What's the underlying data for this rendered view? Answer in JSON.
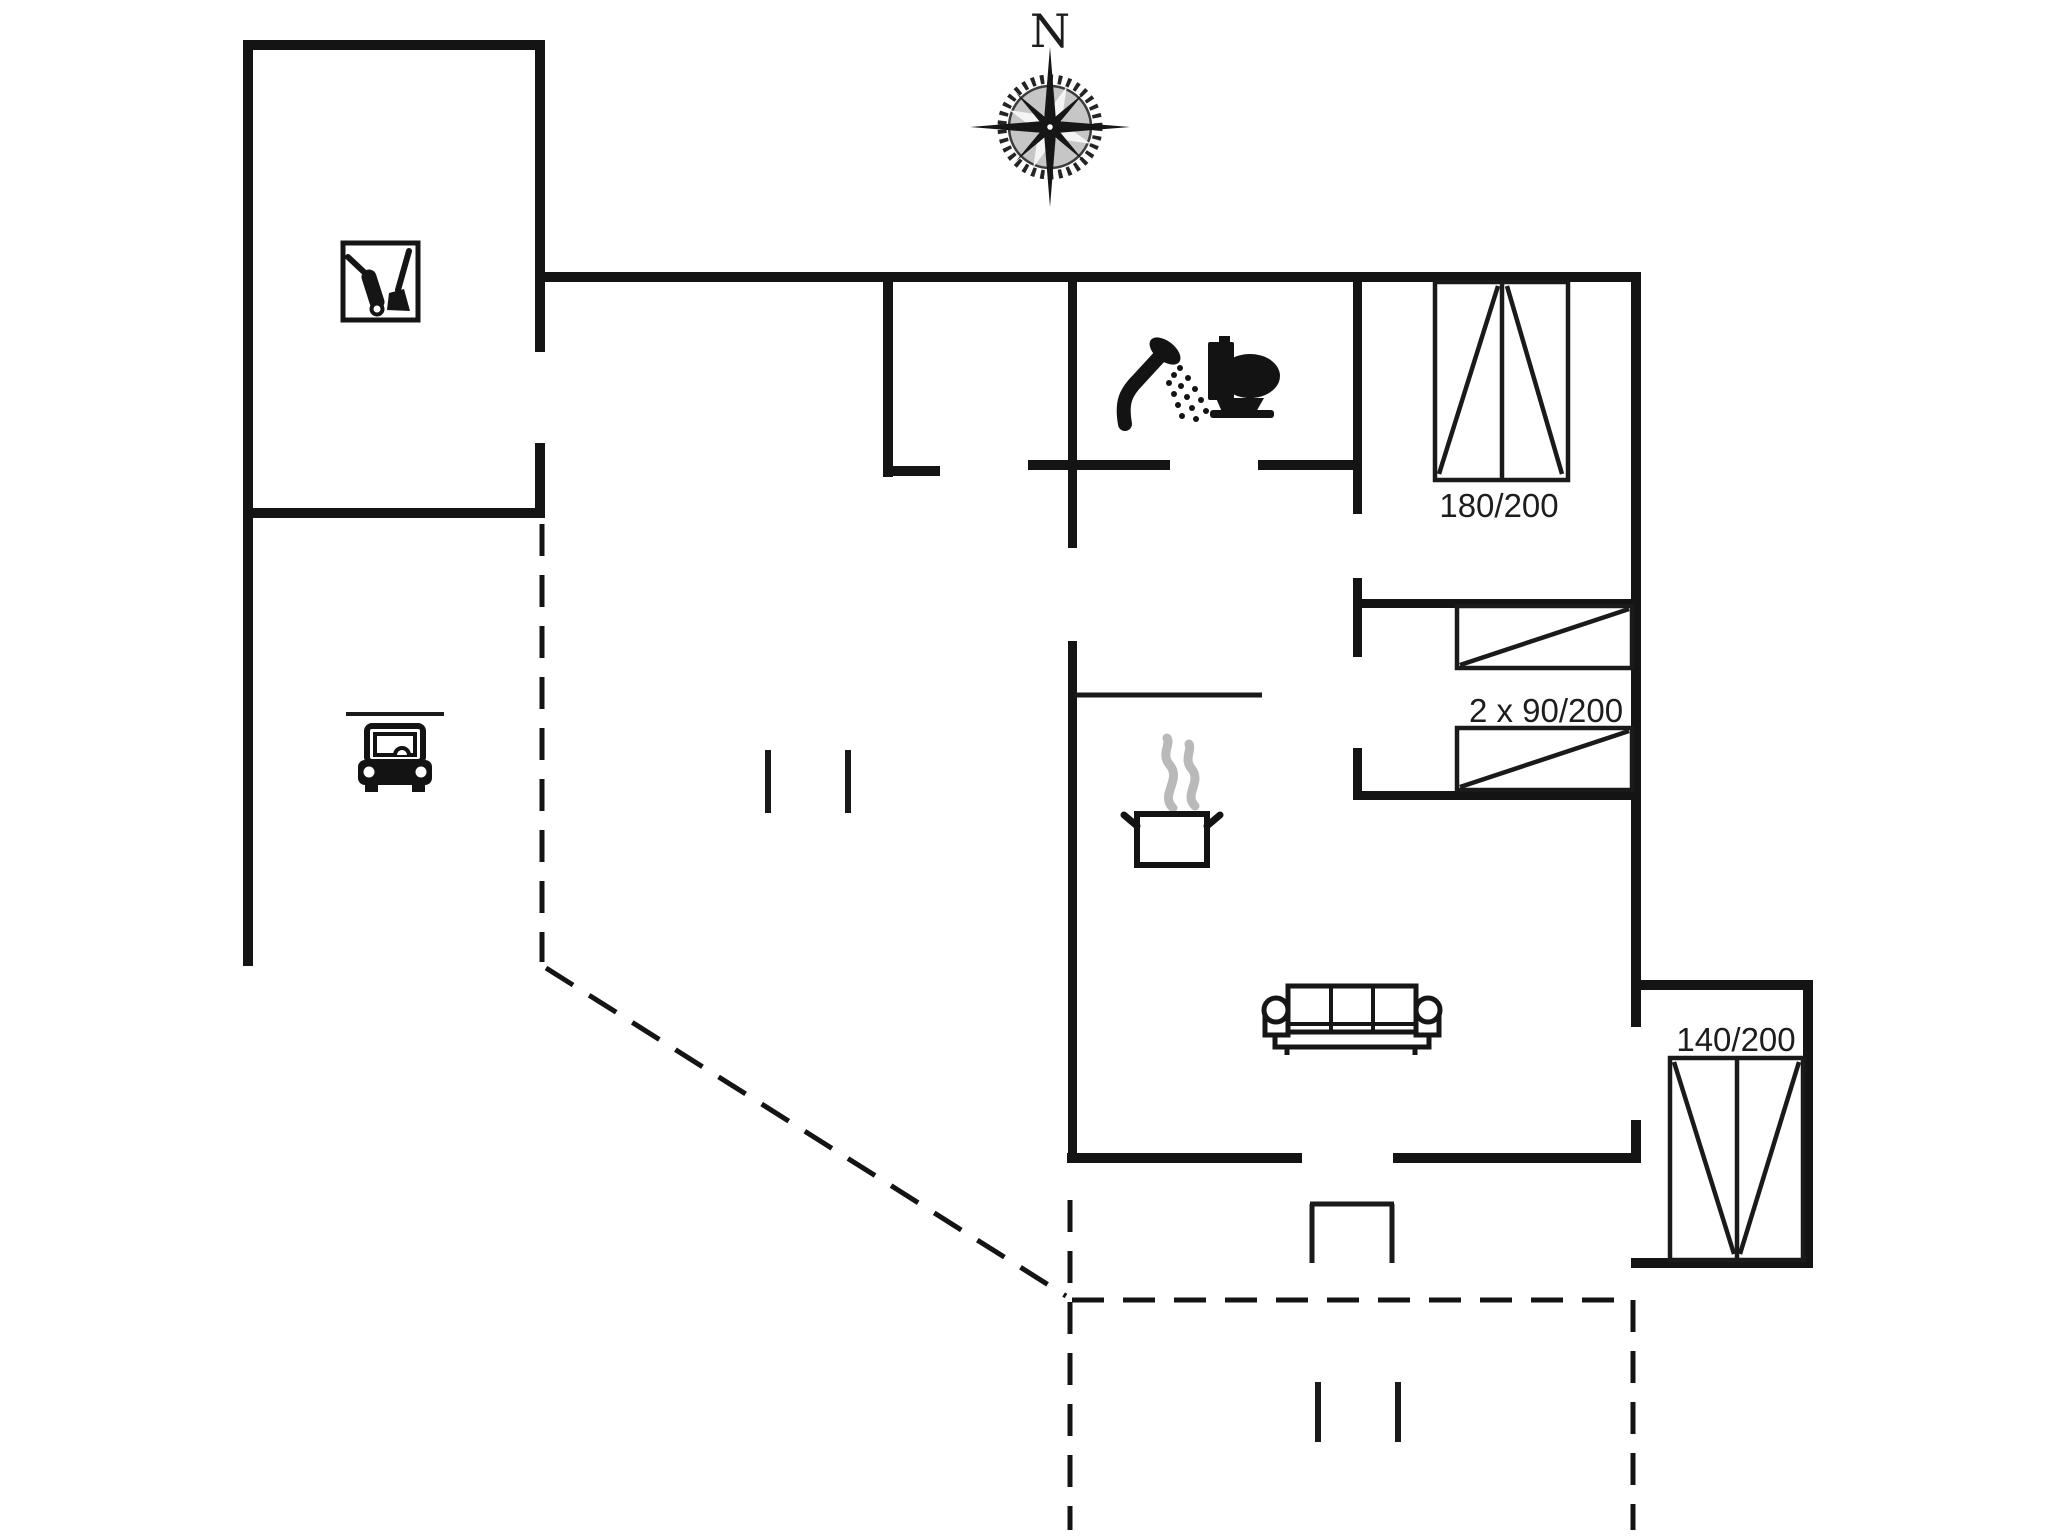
{
  "page": {
    "width": 2048,
    "height": 1536,
    "background": "#ffffff"
  },
  "colors": {
    "wall": "#141414",
    "furniture": "#1a1a1a",
    "steam": "#b9b9b9",
    "text": "#1d1d1d"
  },
  "compass": {
    "cx": 1050,
    "cy": 127,
    "label": "N"
  },
  "labels": [
    {
      "name": "compass-north-label",
      "text": "N",
      "x": 1050,
      "y": 47,
      "size": 46,
      "serif": true
    },
    {
      "name": "bed-double-size-label",
      "text": "180/200",
      "x": 1499,
      "y": 517,
      "size": 33,
      "serif": false
    },
    {
      "name": "bunk-beds-size-label",
      "text": "2 x 90/200",
      "x": 1546,
      "y": 722,
      "size": 33,
      "serif": false
    },
    {
      "name": "bed-annex-size-label",
      "text": "140/200",
      "x": 1736,
      "y": 1051,
      "size": 33,
      "serif": false
    }
  ],
  "walls": [
    {
      "name": "utility-room-north-wall",
      "x": 243,
      "y": 40,
      "w": 302,
      "h": 10
    },
    {
      "name": "utility-room-west-wall",
      "x": 243,
      "y": 40,
      "w": 10,
      "h": 478
    },
    {
      "name": "utility-room-east-wall-upper",
      "x": 535,
      "y": 40,
      "w": 10,
      "h": 312
    },
    {
      "name": "utility-room-east-wall-lower",
      "x": 535,
      "y": 443,
      "w": 10,
      "h": 75
    },
    {
      "name": "utility-carport-divider-wall",
      "x": 243,
      "y": 508,
      "w": 302,
      "h": 10
    },
    {
      "name": "carport-west-wall",
      "x": 243,
      "y": 518,
      "w": 10,
      "h": 448
    },
    {
      "name": "house-north-wall",
      "x": 535,
      "y": 272,
      "w": 1106,
      "h": 10
    },
    {
      "name": "house-east-wall-upper",
      "x": 1631,
      "y": 272,
      "w": 10,
      "h": 755
    },
    {
      "name": "house-east-wall-lower",
      "x": 1631,
      "y": 1120,
      "w": 10,
      "h": 43
    },
    {
      "name": "living-room-south-wall-west",
      "x": 1067,
      "y": 1153,
      "w": 235,
      "h": 10
    },
    {
      "name": "living-room-south-wall-east",
      "x": 1393,
      "y": 1153,
      "w": 248,
      "h": 10
    },
    {
      "name": "hall-west-wall",
      "x": 883,
      "y": 282,
      "w": 10,
      "h": 195
    },
    {
      "name": "hall-south-wall-stub",
      "x": 883,
      "y": 466,
      "w": 57,
      "h": 10
    },
    {
      "name": "bathroom-south-wall-west",
      "x": 1028,
      "y": 460,
      "w": 142,
      "h": 10
    },
    {
      "name": "bathroom-south-wall-east",
      "x": 1258,
      "y": 460,
      "w": 104,
      "h": 10
    },
    {
      "name": "bathroom-west-wall",
      "x": 1068,
      "y": 282,
      "w": 9,
      "h": 266
    },
    {
      "name": "kitchen-west-wall",
      "x": 1068,
      "y": 641,
      "w": 9,
      "h": 512
    },
    {
      "name": "bedroom1-west-wall",
      "x": 1353,
      "y": 282,
      "w": 9,
      "h": 232
    },
    {
      "name": "bedroom2-west-wall-upper",
      "x": 1353,
      "y": 578,
      "w": 9,
      "h": 79
    },
    {
      "name": "bedroom2-west-wall-lower",
      "x": 1353,
      "y": 748,
      "w": 9,
      "h": 47
    },
    {
      "name": "bedroom2-north-wall",
      "x": 1353,
      "y": 599,
      "w": 288,
      "h": 9
    },
    {
      "name": "bedroom2-south-wall",
      "x": 1353,
      "y": 791,
      "w": 288,
      "h": 9
    },
    {
      "name": "annex-north-wall",
      "x": 1641,
      "y": 980,
      "w": 172,
      "h": 10
    },
    {
      "name": "annex-east-wall",
      "x": 1803,
      "y": 980,
      "w": 10,
      "h": 288
    },
    {
      "name": "annex-south-wall",
      "x": 1631,
      "y": 1258,
      "w": 182,
      "h": 10
    }
  ],
  "thin_lines": [
    {
      "name": "kitchen-counter-line",
      "x1": 1074,
      "y1": 695,
      "x2": 1262,
      "y2": 695,
      "w": 5
    },
    {
      "name": "carport-lintel-line",
      "x1": 346,
      "y1": 714,
      "x2": 444,
      "y2": 714,
      "w": 4
    },
    {
      "name": "entry-post-left",
      "x1": 768,
      "y1": 750,
      "x2": 768,
      "y2": 813,
      "w": 6
    },
    {
      "name": "entry-post-right",
      "x1": 848,
      "y1": 750,
      "x2": 848,
      "y2": 813,
      "w": 6
    },
    {
      "name": "terrace-post-left",
      "x1": 1318,
      "y1": 1382,
      "x2": 1318,
      "y2": 1442,
      "w": 6
    },
    {
      "name": "terrace-post-right",
      "x1": 1398,
      "y1": 1382,
      "x2": 1398,
      "y2": 1442,
      "w": 6
    },
    {
      "name": "door-threshold-west",
      "x1": 1312,
      "y1": 1204,
      "x2": 1312,
      "y2": 1263,
      "w": 5
    },
    {
      "name": "door-threshold-east",
      "x1": 1392,
      "y1": 1204,
      "x2": 1392,
      "y2": 1263,
      "w": 5
    },
    {
      "name": "door-threshold-north",
      "x1": 1310,
      "y1": 1204,
      "x2": 1394,
      "y2": 1204,
      "w": 5
    }
  ],
  "dashed_lines": [
    {
      "name": "carport-east-boundary",
      "x1": 542,
      "y1": 524,
      "x2": 542,
      "y2": 962
    },
    {
      "name": "carport-diagonal-boundary",
      "x1": 546,
      "y1": 968,
      "x2": 1066,
      "y2": 1296
    },
    {
      "name": "terrace-west-boundary",
      "x1": 1070,
      "y1": 1200,
      "x2": 1070,
      "y2": 1530
    },
    {
      "name": "terrace-north-boundary",
      "x1": 1072,
      "y1": 1300,
      "x2": 1633,
      "y2": 1300
    },
    {
      "name": "terrace-east-boundary",
      "x1": 1633,
      "y1": 1300,
      "x2": 1633,
      "y2": 1530
    }
  ],
  "beds": [
    {
      "name": "bed-double-180-200",
      "rect": [
        1435,
        282,
        133,
        198
      ],
      "lines": [
        [
          1502,
          282,
          1502,
          480
        ],
        [
          1439,
          474,
          1498,
          286
        ],
        [
          1507,
          286,
          1562,
          474
        ]
      ]
    },
    {
      "name": "bunk-bed-upper-90-200",
      "rect": [
        1457,
        606,
        175,
        62
      ],
      "lines": [
        [
          1460,
          665,
          1629,
          609
        ]
      ]
    },
    {
      "name": "bunk-bed-lower-90-200",
      "rect": [
        1457,
        728,
        175,
        62
      ],
      "lines": [
        [
          1460,
          787,
          1629,
          731
        ]
      ]
    },
    {
      "name": "bed-annex-140-200",
      "rect": [
        1670,
        1058,
        133,
        202
      ],
      "lines": [
        [
          1737,
          1058,
          1737,
          1260
        ],
        [
          1674,
          1062,
          1734,
          1254
        ],
        [
          1799,
          1062,
          1740,
          1254
        ]
      ]
    }
  ],
  "icons": [
    {
      "name": "compass",
      "x": 1050,
      "y": 127
    },
    {
      "name": "cleaning",
      "x": 343,
      "y": 243
    },
    {
      "name": "car",
      "x": 357,
      "y": 724
    },
    {
      "name": "shower",
      "x": 1108,
      "y": 336
    },
    {
      "name": "toilet",
      "x": 1208,
      "y": 336
    },
    {
      "name": "pot",
      "x": 1123,
      "y": 736
    },
    {
      "name": "sofa",
      "x": 1263,
      "y": 983
    }
  ]
}
